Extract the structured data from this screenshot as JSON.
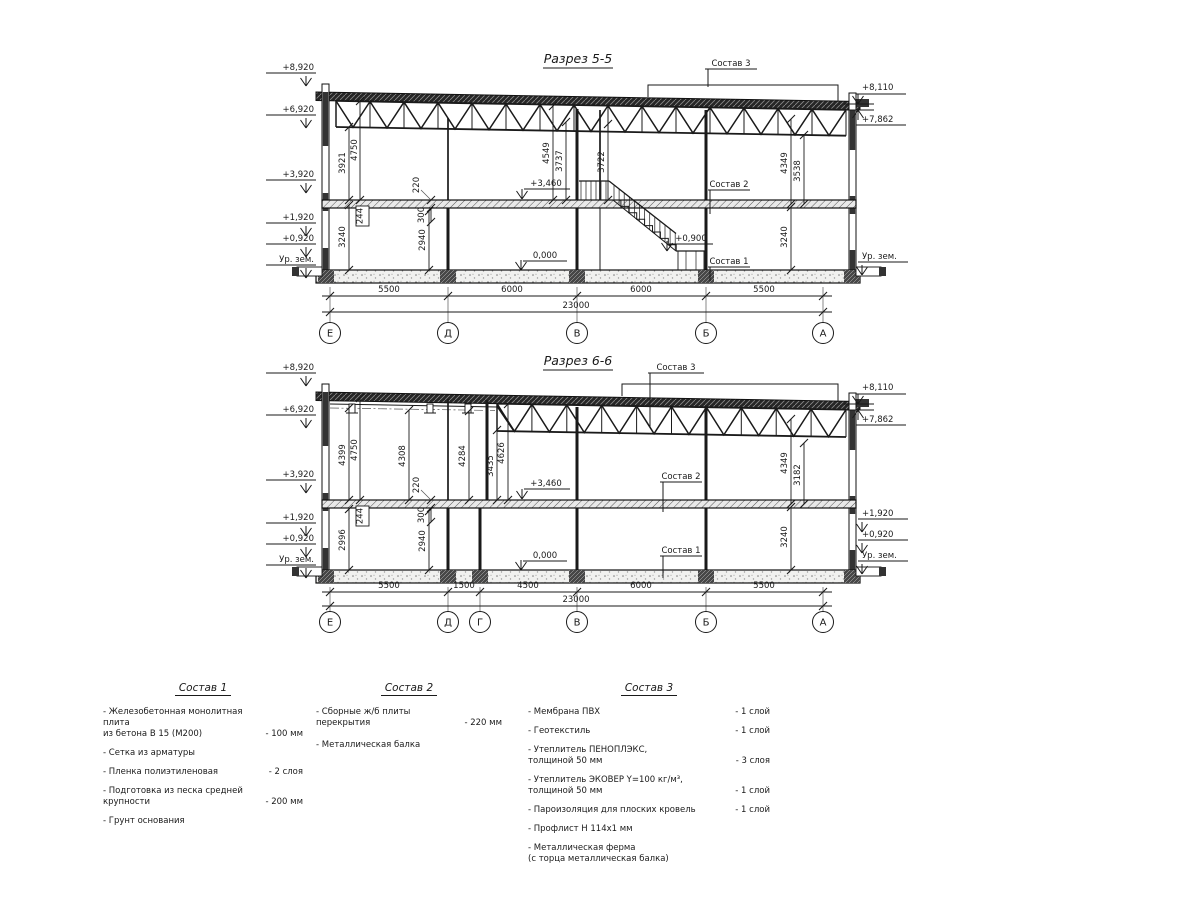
{
  "s55": {
    "title": "Разрез 5-5",
    "elev": {
      "e8920": "+8,920",
      "e6920": "+6,920",
      "e3920": "+3,920",
      "e1920": "+1,920",
      "e0920": "+0,920",
      "ur": "Ур. зем."
    },
    "right": {
      "e8110": "+8,110",
      "e7862": "+7,862",
      "ur": "Ур. зем."
    },
    "lv": {
      "l3460": "+3,460",
      "l0": "0,000",
      "l09": "+0,900"
    },
    "so": {
      "s1": "Состав 1",
      "s2": "Состав 2",
      "s3": "Состав 3"
    },
    "vd": {
      "a": "3921",
      "b": "4750",
      "c": "4549",
      "d": "3737",
      "e": "3722",
      "f": "4349",
      "g": "3538",
      "h": "3240",
      "i": "2940",
      "j": "3240",
      "k": "244",
      "l": "300",
      "m": "220"
    },
    "bd": [
      "5500",
      "6000",
      "6000",
      "5500"
    ],
    "total": "23000",
    "axes": [
      "Е",
      "Д",
      "В",
      "Б",
      "А"
    ]
  },
  "s66": {
    "title": "Разрез 6-6",
    "elev": {
      "e8920": "+8,920",
      "e6920": "+6,920",
      "e3920": "+3,920",
      "e1920": "+1,920",
      "e0920": "+0,920",
      "ur": "Ур. зем."
    },
    "right": {
      "e8110": "+8,110",
      "e7862": "+7,862",
      "e1920": "+1,920",
      "e0920": "+0,920",
      "ur": "Ур. зем."
    },
    "lv": {
      "l3460": "+3,460",
      "l0": "0,000"
    },
    "so": {
      "s1": "Состав 1",
      "s2": "Состав 2",
      "s3": "Состав 3"
    },
    "vd": {
      "a": "4399",
      "b": "4750",
      "c": "4308",
      "d": "4284",
      "e": "3435",
      "f": "4626",
      "g": "2996",
      "h": "2940",
      "i": "4349",
      "j": "3182",
      "k": "3240",
      "l": "244",
      "m": "300",
      "n": "220"
    },
    "bd": [
      "5500",
      "1500",
      "4500",
      "6000",
      "5500"
    ],
    "total": "23000",
    "axes": [
      "Е",
      "Д",
      "Г",
      "В",
      "Б",
      "А"
    ]
  },
  "legend": {
    "col1": {
      "title": "Состав 1",
      "items": [
        {
          "n": "- Железобетонная  монолитная плита\nиз бетона В 15 (М200)",
          "v": "- 100 мм"
        },
        {
          "n": "- Сетка из арматуры",
          "v": ""
        },
        {
          "n": "- Пленка полиэтиленовая",
          "v": "- 2 слоя"
        },
        {
          "n": "- Подготовка из песка средней\nкрупности",
          "v": "- 200 мм"
        },
        {
          "n": "- Грунт основания",
          "v": ""
        }
      ]
    },
    "col2": {
      "title": "Состав 2",
      "items": [
        {
          "n": "- Сборные ж/б плиты перекрытия",
          "v": "- 220 мм"
        },
        {
          "n": "- Металлическая балка",
          "v": ""
        }
      ]
    },
    "col3": {
      "title": "Состав 3",
      "items": [
        {
          "n": "- Мембрана ПВХ",
          "v": "- 1 слой"
        },
        {
          "n": "- Геотекстиль",
          "v": "- 1 слой"
        },
        {
          "n": "- Утеплитель ПЕНОПЛЭКС,\nтолщиной 50 мм",
          "v": "- 3 слоя"
        },
        {
          "n": "- Утеплитель ЭКОВЕР Y=100 кг/м³,\nтолщиной 50 мм",
          "v": "- 1 слой"
        },
        {
          "n": "- Пароизоляция для плоских кровель",
          "v": "- 1 слой"
        },
        {
          "n": "- Профлист Н 114х1 мм",
          "v": ""
        },
        {
          "n": "- Металлическая ферма\n(с торца металлическая балка)",
          "v": ""
        }
      ]
    }
  }
}
